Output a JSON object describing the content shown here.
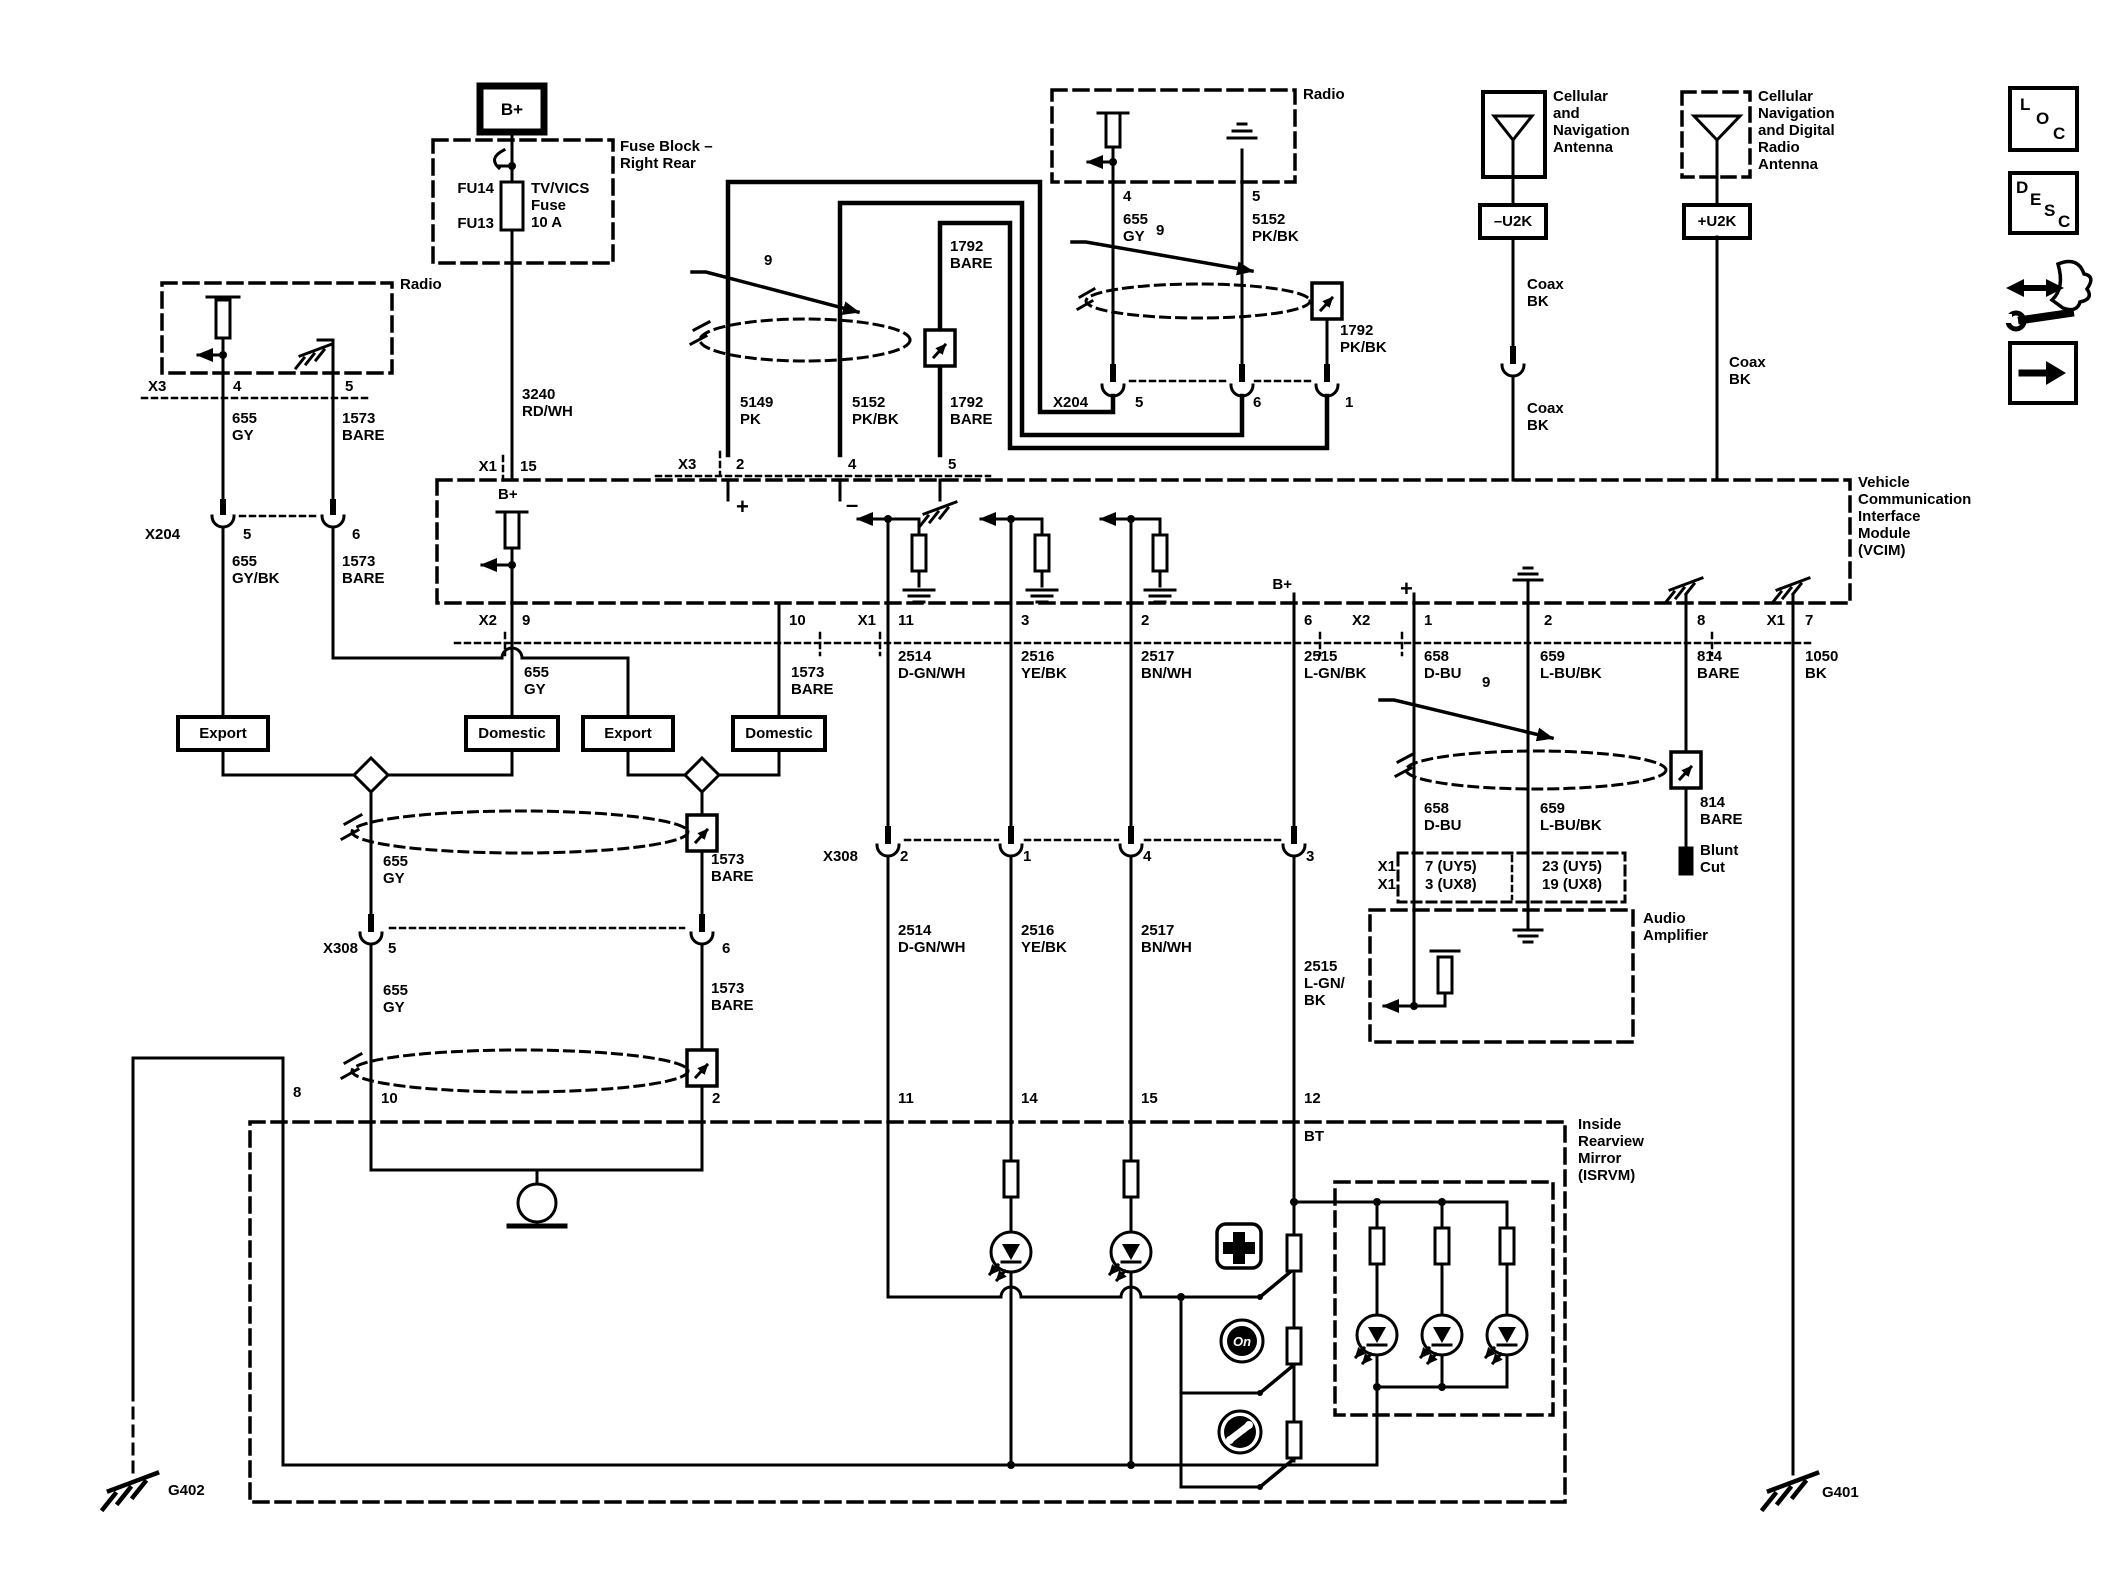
{
  "power": {
    "b_plus": "B+",
    "fuse_block_title": "Fuse Block –\nRight Rear",
    "fu14": "FU14",
    "fu13": "FU13",
    "fuse_desc": "TV/VICS\nFuse\n10 A",
    "w3240": "3240\nRD/WH"
  },
  "radio_left": {
    "title": "Radio",
    "x3": "X3",
    "p4": "4",
    "p5": "5",
    "w655": "655\nGY",
    "w1573": "1573\nBARE",
    "x204": "X204",
    "p5b": "5",
    "p6b": "6",
    "w655bk": "655\nGY/BK",
    "w1573b": "1573\nBARE"
  },
  "radio_mid": {
    "title": "Radio",
    "p4": "4",
    "p5": "5",
    "w655": "655\nGY",
    "w5152": "5152\nPK/BK",
    "w1792pk": "1792\nPK/BK",
    "x204": "X204",
    "p5h": "5",
    "p6h": "6",
    "p1h": "1"
  },
  "trio": {
    "w1792top": "1792\nBARE",
    "w5149": "5149\nPK",
    "w5152": "5152\nPK/BK",
    "w1792": "1792\nBARE",
    "x3": "X3",
    "p2": "2",
    "p4": "4",
    "p5": "5"
  },
  "antenna1": {
    "label": "Cellular\nand\nNavigation\nAntenna",
    "u2k": "–U2K",
    "coax_a": "Coax\nBK",
    "coax_b": "Coax\nBK"
  },
  "antenna2": {
    "label": "Cellular\nNavigation\nand Digital\nRadio\nAntenna",
    "u2k": "+U2K",
    "coax": "Coax\nBK"
  },
  "nav": {
    "loc": [
      "L",
      "O",
      "C"
    ],
    "desc": [
      "D",
      "E",
      "S",
      "C"
    ]
  },
  "vcim": {
    "label": "Vehicle\nCommunication\nInterface\nModule\n(VCIM)",
    "b_in": "B+",
    "b_pin6": "B+",
    "plus": "+",
    "minus": "–",
    "x1_top": "X1",
    "p15": "15",
    "x2": "X2",
    "p9": "9",
    "p10": "10",
    "x1": "X1",
    "p11": "11",
    "p3": "3",
    "p2": "2",
    "p6": "6",
    "x2r": "X2",
    "p1r": "1",
    "p2r": "2",
    "p8r": "8",
    "x1r": "X1",
    "p7r": "7"
  },
  "market": {
    "export": "Export",
    "domestic": "Domestic"
  },
  "wires": {
    "w655": "655\nGY",
    "w1573": "1573\nBARE",
    "w2514": "2514\nD-GN/WH",
    "w2516": "2516\nYE/BK",
    "w2517": "2517\nBN/WH",
    "w2515": "2515\nL-GN/BK",
    "w2515b": "2515\nL-GN/\nBK",
    "w658": "658\nD-BU",
    "w659": "659\nL-BU/BK",
    "w814": "814\nBARE",
    "w1050": "1050\nBK"
  },
  "x308": {
    "name": "X308",
    "p5": "5",
    "p6": "6",
    "p2": "2",
    "p1": "1",
    "p4": "4",
    "p3": "3"
  },
  "isrvm": {
    "label": "Inside\nRearview\nMirror\n(ISRVM)",
    "p8": "8",
    "p10": "10",
    "p2": "2",
    "p11": "11",
    "p14": "14",
    "p15": "15",
    "p12": "12",
    "bt": "BT",
    "onstar": "On"
  },
  "amp": {
    "label": "Audio\nAmplifier",
    "x1a": "X1",
    "x1b": "X1",
    "pin_a": "7 (UY5)",
    "pin_b": "3 (UX8)",
    "pin_c": "23 (UY5)",
    "pin_d": "19 (UX8)"
  },
  "misc": {
    "nine": "9",
    "blunt_cut": "Blunt\nCut",
    "g402": "G402",
    "g401": "G401"
  }
}
